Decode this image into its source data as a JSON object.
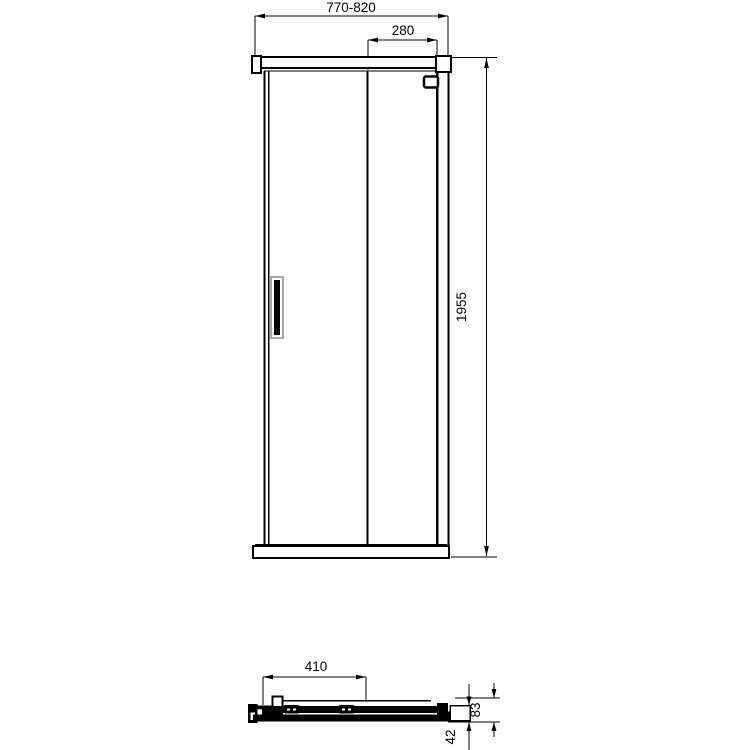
{
  "drawing": {
    "title": "shower-door-technical-drawing",
    "line_color": "#000000",
    "background_color": "#ffffff",
    "front_view": {
      "dim_overall_width": "770-820",
      "dim_door_panel_width": "280",
      "dim_height": "1955"
    },
    "section_view": {
      "dim_base_length": "410",
      "dim_total_depth": "83",
      "dim_rail_height": "42"
    }
  }
}
